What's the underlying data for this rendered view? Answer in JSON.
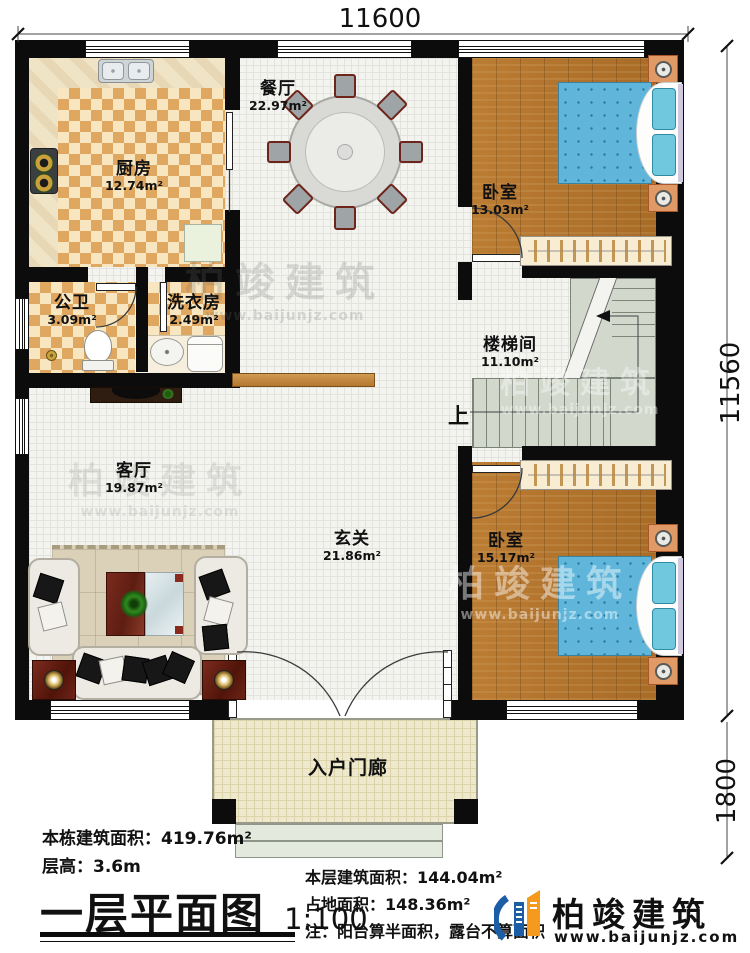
{
  "title_block": {
    "title": "一层平面图",
    "scale": "1:100"
  },
  "stats_left": {
    "total_area_label": "本栋建筑面积：",
    "total_area_value": "419.76m²",
    "floor_height_label": "层高：",
    "floor_height_value": "3.6m"
  },
  "stats_right": {
    "floor_area_label": "本层建筑面积：",
    "floor_area_value": "144.04m²",
    "footprint_label": "占地面积：",
    "footprint_value": "148.36m²",
    "note": "注：阳台算半面积，露台不算面积"
  },
  "brand": {
    "name": "柏竣建筑",
    "website": "www.baijunjz.com",
    "blue": "#1b5ea6",
    "orange": "#f59a1c"
  },
  "watermark": {
    "name": "柏竣建筑",
    "website": "www.baijunjz.com"
  },
  "dimensions": {
    "top_width": "11600",
    "right_height": "11560",
    "porch_depth": "1800"
  },
  "stairs": {
    "direction_label": "上"
  },
  "rooms": [
    {
      "id": "kitchen",
      "name": "厨房",
      "area": "12.74m²"
    },
    {
      "id": "dining",
      "name": "餐厅",
      "area": "22.97m²"
    },
    {
      "id": "bedroom1",
      "name": "卧室",
      "area": "13.03m²"
    },
    {
      "id": "bath",
      "name": "公卫",
      "area": "3.09m²"
    },
    {
      "id": "laundry",
      "name": "洗衣房",
      "area": "2.49m²"
    },
    {
      "id": "stairwell",
      "name": "楼梯间",
      "area": "11.10m²"
    },
    {
      "id": "living",
      "name": "客厅",
      "area": "19.87m²"
    },
    {
      "id": "foyer",
      "name": "玄关",
      "area": "21.86m²"
    },
    {
      "id": "bedroom2",
      "name": "卧室",
      "area": "15.17m²"
    },
    {
      "id": "porch",
      "name": "入户门廊"
    }
  ]
}
